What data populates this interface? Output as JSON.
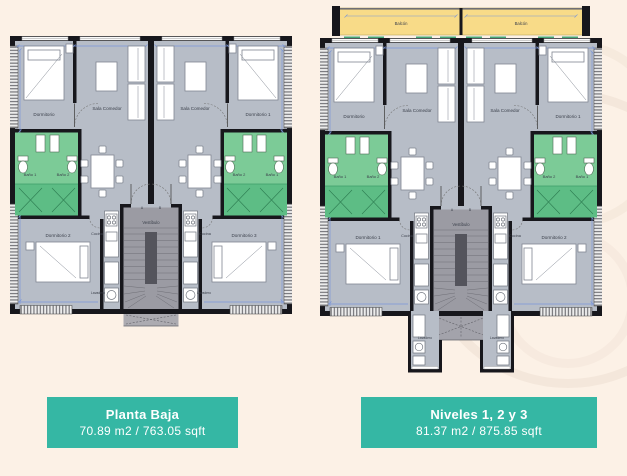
{
  "colors": {
    "background": "#fcf1e6",
    "floor_gray": "#b7bdc7",
    "wall_black": "#17171c",
    "bath_green": "#7ccb97",
    "bath_green_dark": "#5dbd85",
    "balcony_yellow": "#f8db88",
    "vestibule_gray": "#9b9ba3",
    "dimension_blue": "#7b96d8",
    "caption_teal": "#35b7a4"
  },
  "plans": {
    "left": {
      "rooms": {
        "dormitorio_tl": "Dormitorio",
        "sala_left": "Sala Comedor",
        "sala_right": "Sala Comedor",
        "dormitorio_tr": "Dormitorio 1",
        "bano1_left": "Baño 1",
        "bano2_left": "Baño 2",
        "bano2_right": "Baño 2",
        "bano1_right": "Baño 1",
        "dormitorio_bl": "Dormitorio 2",
        "dormitorio_br": "Dormitorio 3",
        "cocina_left": "Cocina",
        "cocina_right": "Cocina",
        "vestibulo": "Vestíbulo",
        "lavadero_left": "Lavadero",
        "lavadero_right": "Lavadero",
        "door_a": "A",
        "door_b": "B"
      }
    },
    "right": {
      "rooms": {
        "balcon_left": "Balcón",
        "balcon_right": "Balcón",
        "dormitorio_tl": "Dormitorio",
        "sala_left": "Sala Comedor",
        "sala_right": "Sala Comedor",
        "dormitorio_tr": "Dormitorio 1",
        "bano1_left": "Baño 1",
        "bano2_left": "Baño 2",
        "bano2_right": "Baño 2",
        "bano1_right": "Baño 1",
        "dormitorio_bl": "Dormitorio 1",
        "dormitorio_br": "Dormitorio 2",
        "cocina_left": "Cocina",
        "cocina_right": "Cocina",
        "vestibulo": "Vestíbulo",
        "lavadero_left": "Lavadero",
        "lavadero_right": "Lavadero",
        "door_a": "A",
        "door_b": "B"
      }
    }
  },
  "captions": {
    "left": {
      "title": "Planta Baja",
      "area": "70.89 m2 / 763.05 sqft"
    },
    "right": {
      "title": "Niveles 1, 2 y 3",
      "area": "81.37 m2 / 875.85 sqft"
    }
  }
}
